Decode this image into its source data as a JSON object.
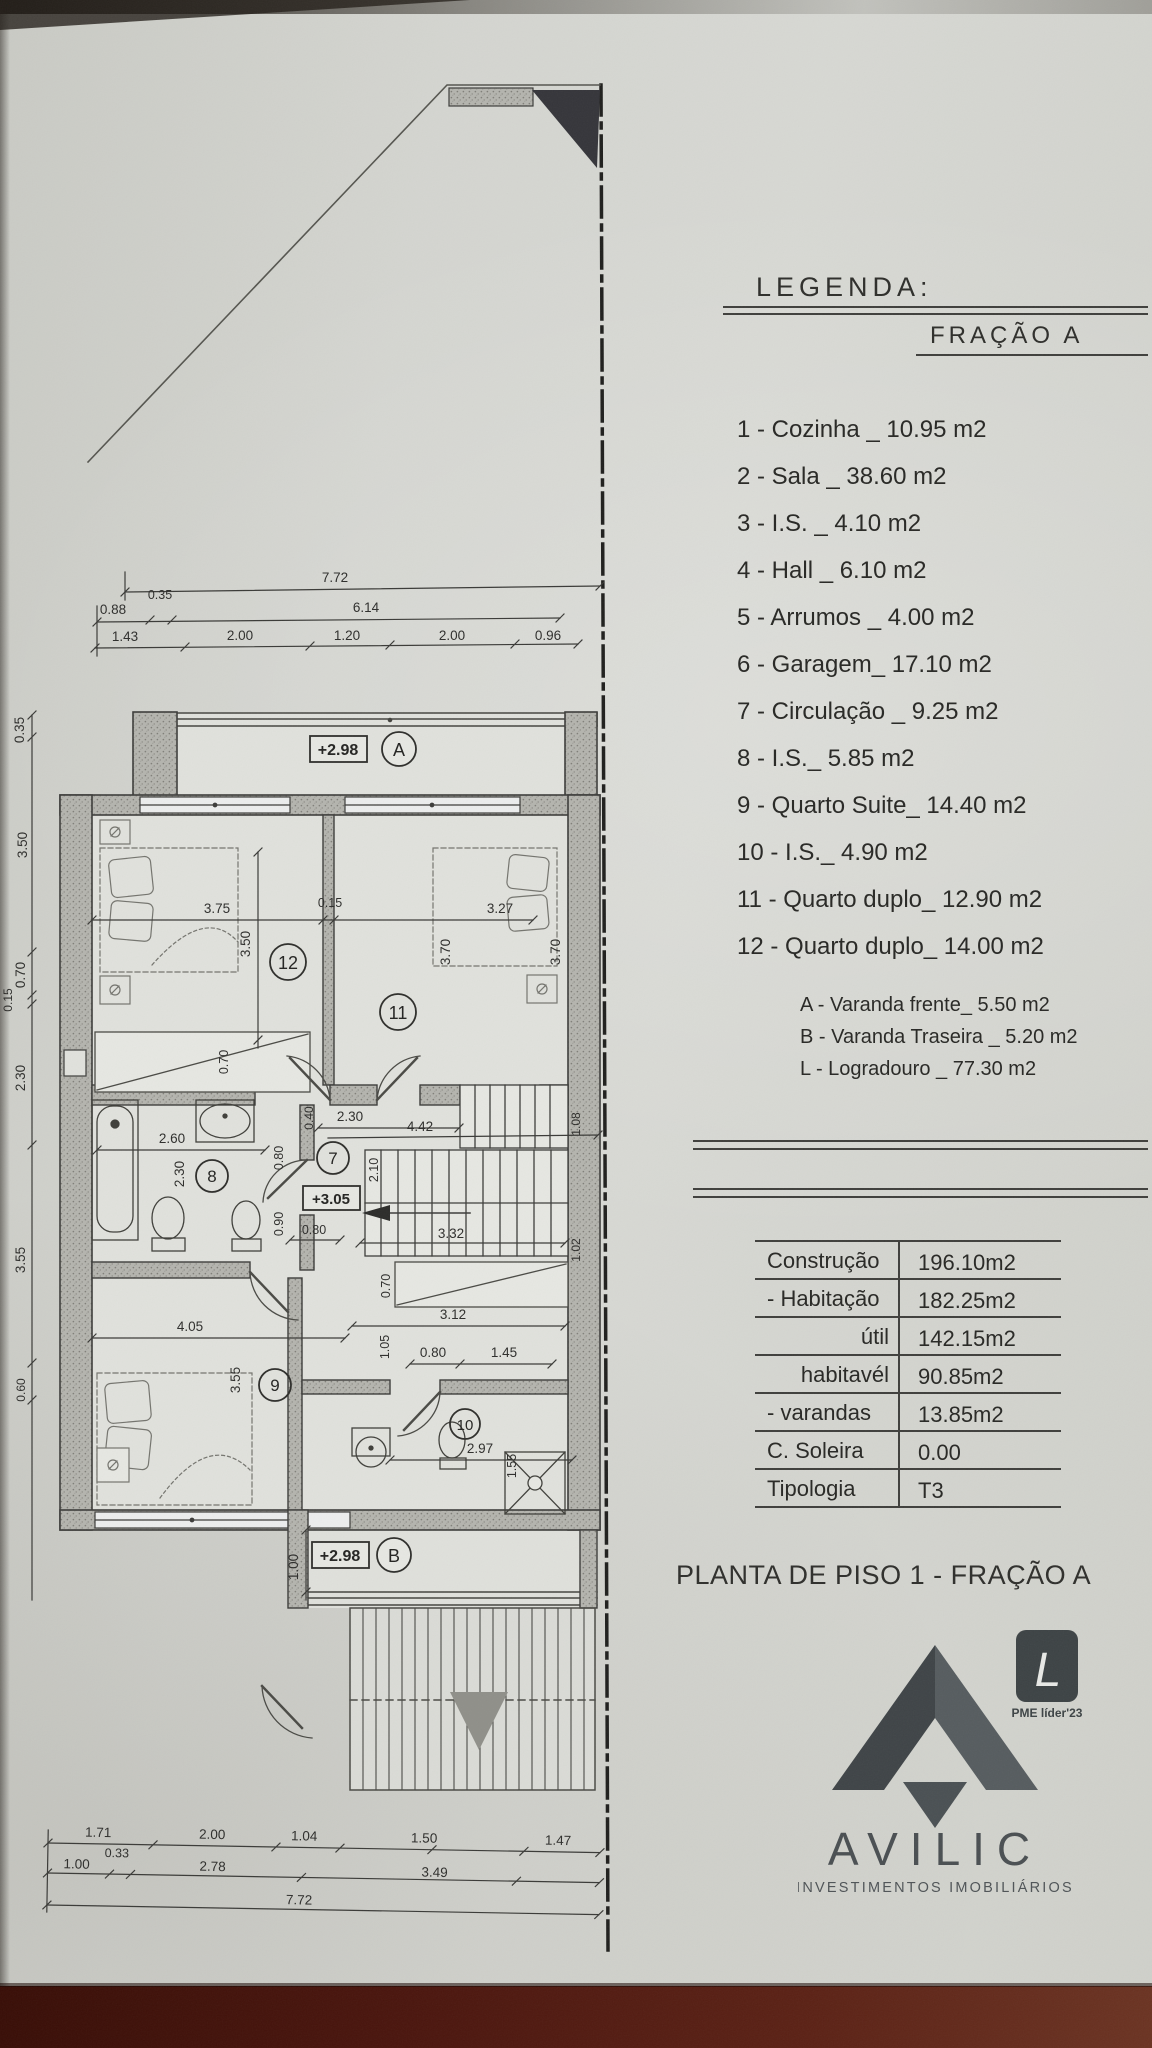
{
  "legend": {
    "title": "LEGENDA:",
    "fraction": "FRAÇÃO A",
    "items": [
      "1 - Cozinha _ 10.95 m2",
      "2 - Sala  _ 38.60 m2",
      "3 - I.S. _ 4.10 m2",
      "4 - Hall _ 6.10 m2",
      "5 - Arrumos _ 4.00 m2",
      "6 - Garagem_ 17.10 m2",
      "7 - Circulação _ 9.25 m2",
      "8 - I.S._ 5.85 m2",
      "9 - Quarto Suite_ 14.40 m2",
      "10 - I.S._ 4.90 m2",
      "11 - Quarto duplo_ 12.90 m2",
      "12 - Quarto duplo_ 14.00 m2"
    ],
    "sub_items": [
      "A - Varanda frente_ 5.50 m2",
      "B - Varanda Traseira _ 5.20 m2",
      "L - Logradouro _ 77.30 m2"
    ]
  },
  "areas_table": {
    "rows": [
      {
        "label": "Construção",
        "value": "196.10m2"
      },
      {
        "label": "- Habitação",
        "value": "182.25m2"
      },
      {
        "label": "útil",
        "value": "142.15m2"
      },
      {
        "label": "habitavél",
        "value": "90.85m2"
      },
      {
        "label": "- varandas",
        "value": "13.85m2"
      },
      {
        "label": "C. Soleira",
        "value": "0.00"
      },
      {
        "label": "Tipologia",
        "value": "T3"
      }
    ]
  },
  "title": "PLANTA DE PISO 1 - FRAÇÃO A",
  "logo": {
    "name": "AVILIC",
    "tagline": "INVESTIMENTOS IMOBILIÁRIOS",
    "badge_letter": "L",
    "badge_caption": "PME líder'23",
    "brand_color": "#4a4f52"
  },
  "photo": {
    "desk_color": "#4a150d",
    "paper_color": "#d4d5d0"
  },
  "plan": {
    "levels": {
      "varanda_a": "+2.98",
      "stairs": "+3.05",
      "varanda_b": "+2.98"
    },
    "room_numbers": {
      "r7": "7",
      "r8": "8",
      "r9": "9",
      "r10": "10",
      "r11": "11",
      "r12": "12"
    },
    "balcony_letters": {
      "a": "A",
      "b": "B"
    },
    "dims": {
      "top1": [
        "7.72"
      ],
      "top2": [
        "0.88",
        "0.35",
        "6.14"
      ],
      "top3": [
        "1.43",
        "2.00",
        "1.20",
        "2.00",
        "0.96"
      ],
      "left": [
        "0.35",
        "3.50",
        "0.70",
        "0.15",
        "2.30",
        "3.55",
        "0.60"
      ],
      "bottom1": [
        "1.71",
        "2.00",
        "1.04",
        "1.50",
        "1.47"
      ],
      "bottom2": [
        "1.00",
        "0.33",
        "2.78",
        "3.49"
      ],
      "bottom3": [
        "7.72"
      ],
      "room12": [
        "3.75",
        "0.15",
        "3.50",
        "0.70"
      ],
      "room11": [
        "3.27",
        "3.70",
        "3.70"
      ],
      "bath8": [
        "2.60",
        "2.30",
        "0.80",
        "0.90",
        "0.80"
      ],
      "hall7": [
        "0.40",
        "2.30",
        "4.42",
        "3.32",
        "2.10",
        "1.08",
        "1.02",
        "0.70"
      ],
      "room9": [
        "4.05",
        "3.55",
        "3.12",
        "1.05",
        "0.80",
        "1.45"
      ],
      "bath10": [
        "2.97",
        "1.55",
        "1.00"
      ]
    }
  }
}
